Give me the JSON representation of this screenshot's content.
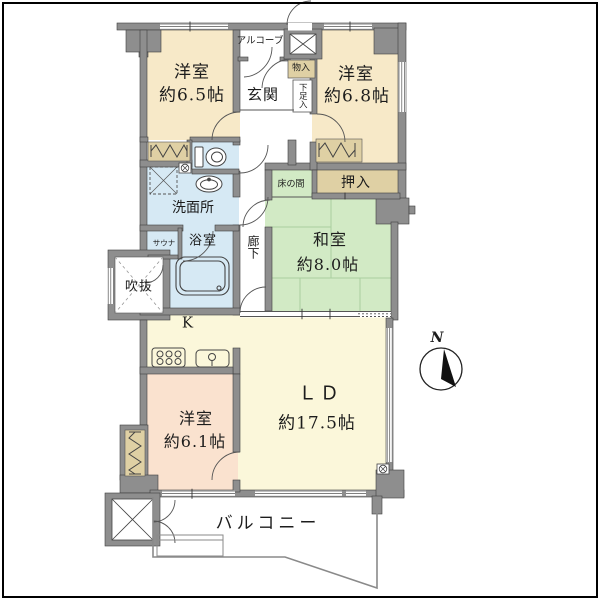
{
  "page": {
    "background": "#ffffff",
    "frame_border": "#000000"
  },
  "palette": {
    "wall": "#8e8e8e",
    "western_room": "#f7e9c8",
    "western_room_small": "#fae2cf",
    "living_dining": "#fbf7da",
    "japanese_room": "#d2eac5",
    "wet_area": "#d6e9f4",
    "storage": "#dfd0a4"
  },
  "rooms": {
    "yoshitsu65": {
      "name": "洋室",
      "size": "約6.5帖"
    },
    "yoshitsu68": {
      "name": "洋室",
      "size": "約6.8帖"
    },
    "yoshitsu61": {
      "name": "洋室",
      "size": "約6.1帖"
    },
    "washitsu": {
      "name": "和室",
      "size": "約8.0帖"
    },
    "ld": {
      "name": "ＬＤ",
      "size": "約17.5帖"
    },
    "kitchen": {
      "name": "K"
    },
    "genkan": {
      "name": "玄関"
    },
    "alcove": {
      "name": "アルコーブ"
    },
    "monoire": {
      "name": "物入"
    },
    "kutsubako": {
      "name": "下足入"
    },
    "oshiire": {
      "name": "押入"
    },
    "tokonoma": {
      "name": "床の間"
    },
    "senmenjo": {
      "name": "洗面所"
    },
    "yokushitsu": {
      "name": "浴室"
    },
    "sauna": {
      "name": "サウナ"
    },
    "fukinuke": {
      "name": "吹抜"
    },
    "rouka": {
      "name": "廊下"
    },
    "balcony": {
      "name": "バルコニー"
    }
  },
  "compass": {
    "label": "N"
  }
}
